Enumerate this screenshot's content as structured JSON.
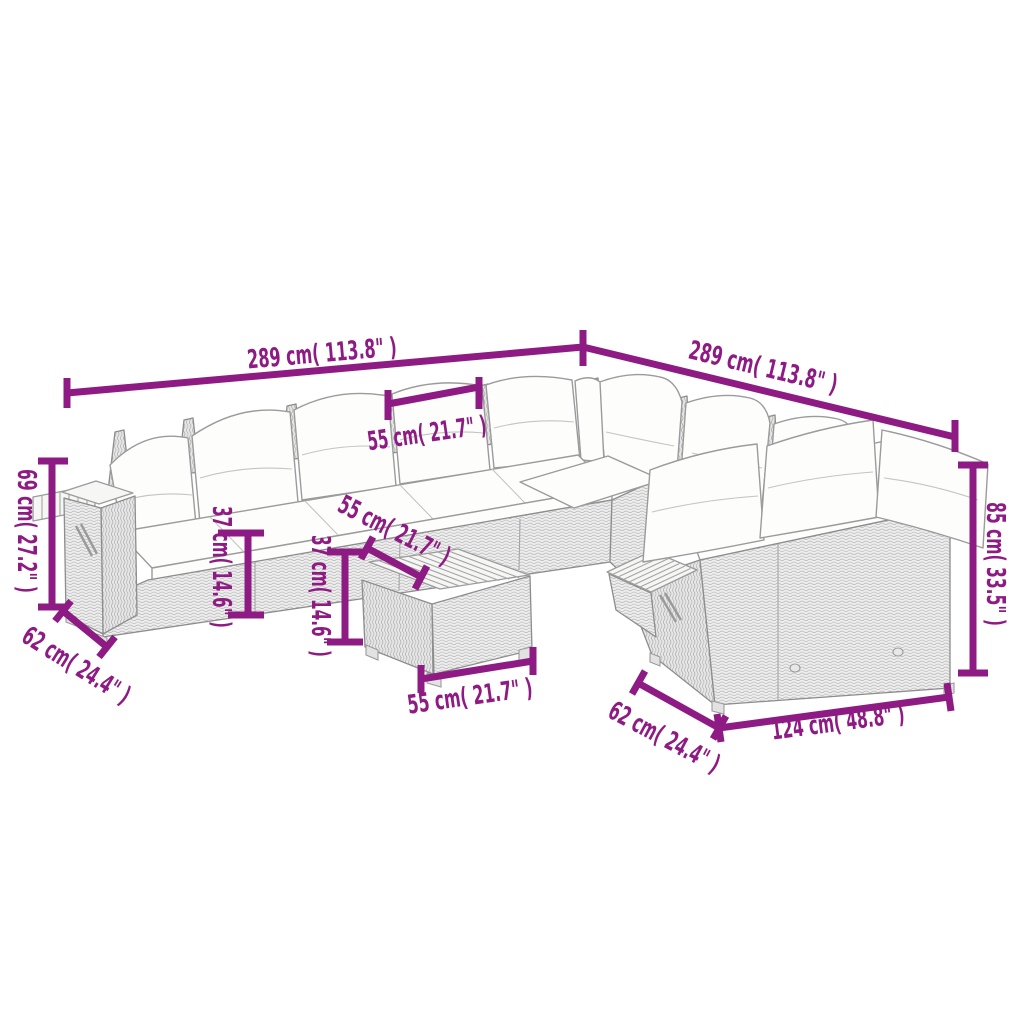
{
  "colors": {
    "dimension_accent": "#8E1B83",
    "line_art": "#8d8d8d"
  },
  "diagram": {
    "type": "product-dimension-drawing",
    "subject": "corner-sofa-set-with-table",
    "labels": {
      "width_left_run": "289 cm( 113.8\" )",
      "width_right_run": "289 cm( 113.8\" )",
      "seat_width_back": "55 cm( 21.7\" )",
      "arm_height_left": "69 cm( 27.2\" )",
      "depth_left": "62 cm( 24.4\" )",
      "seat_height_left": "37 cm( 14.6\" )",
      "seat_height_middle": "37 cm( 14.6\" )",
      "table_width_top": "55 cm( 21.7\" )",
      "table_width_front": "55 cm( 21.7\" )",
      "depth_right": "62 cm( 24.4\" )",
      "bench_width_front": "124 cm( 48.8\" )",
      "back_height_right": "85 cm( 33.5\" )"
    }
  }
}
